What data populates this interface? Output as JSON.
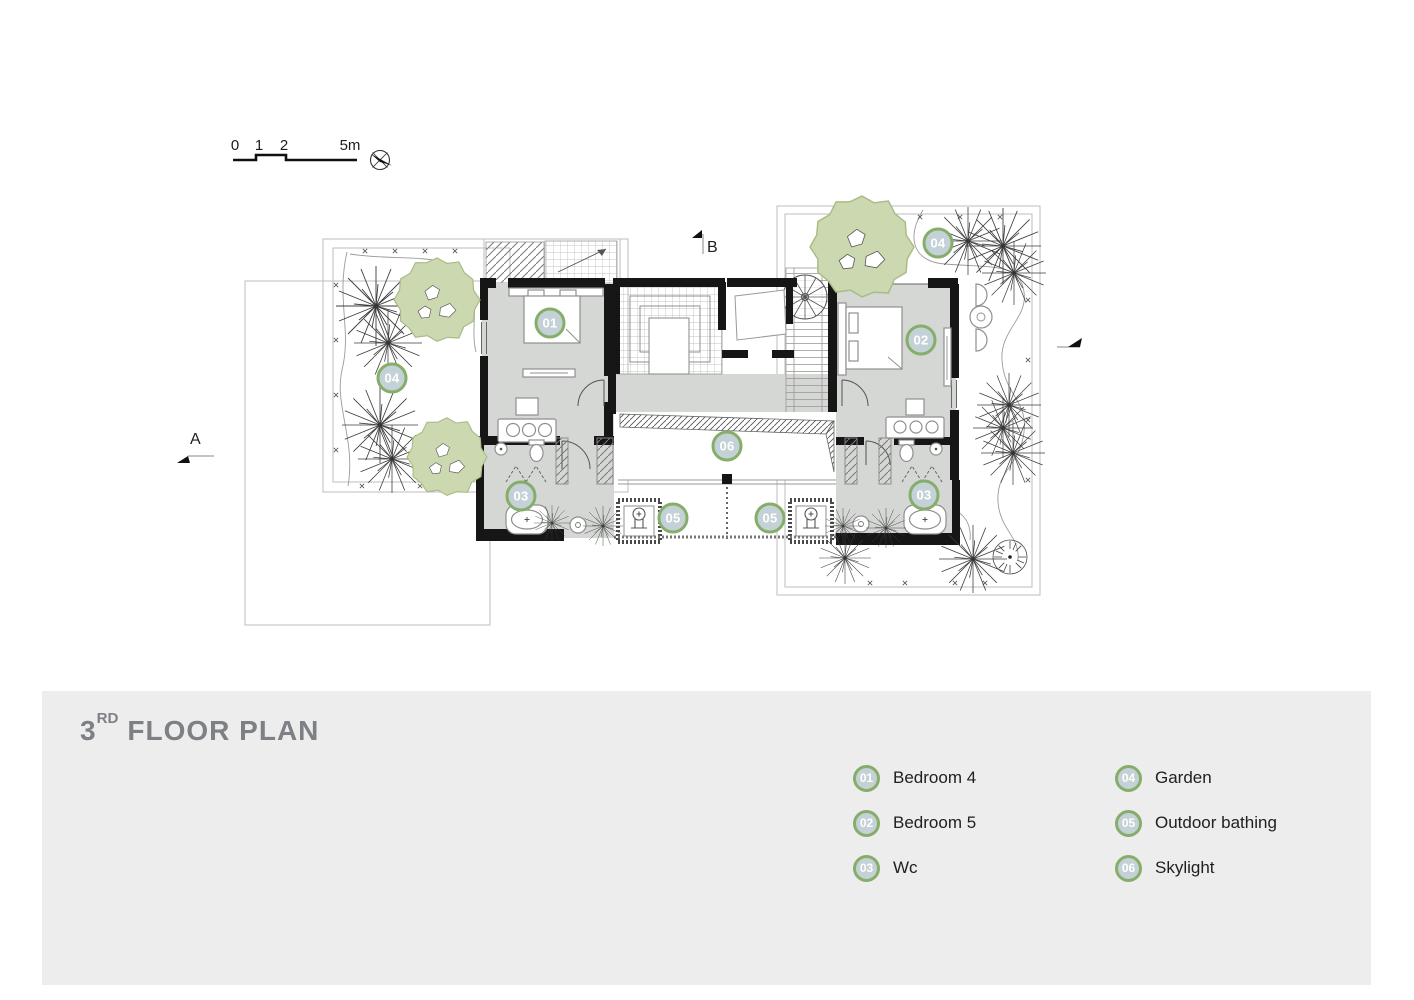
{
  "colors": {
    "canopy": "#ccd8af",
    "canopy_edge": "#a9bb86",
    "floor": "#d4d7d3",
    "wall": "#161616",
    "marker_ring": "#86ad6a",
    "marker_fill": "#c4d2d8",
    "marker_text": "#ffffff",
    "band": "#ededee",
    "title": "#7d8084",
    "ink": "#202020"
  },
  "scalebar": {
    "ticks": [
      "0",
      "1",
      "2"
    ],
    "end": "5m"
  },
  "sections": {
    "a": "A",
    "b": "B"
  },
  "plan_markers": {
    "m01": "01",
    "m02": "02",
    "m03": "03",
    "m04": "04",
    "m05": "05",
    "m06": "06"
  },
  "title": {
    "num": "3",
    "sup": "RD",
    "rest": "FLOOR PLAN"
  },
  "legend": {
    "items": [
      {
        "num": "01",
        "label": "Bedroom 4"
      },
      {
        "num": "02",
        "label": "Bedroom 5"
      },
      {
        "num": "03",
        "label": "Wc"
      },
      {
        "num": "04",
        "label": "Garden"
      },
      {
        "num": "05",
        "label": "Outdoor bathing"
      },
      {
        "num": "06",
        "label": "Skylight"
      }
    ]
  }
}
